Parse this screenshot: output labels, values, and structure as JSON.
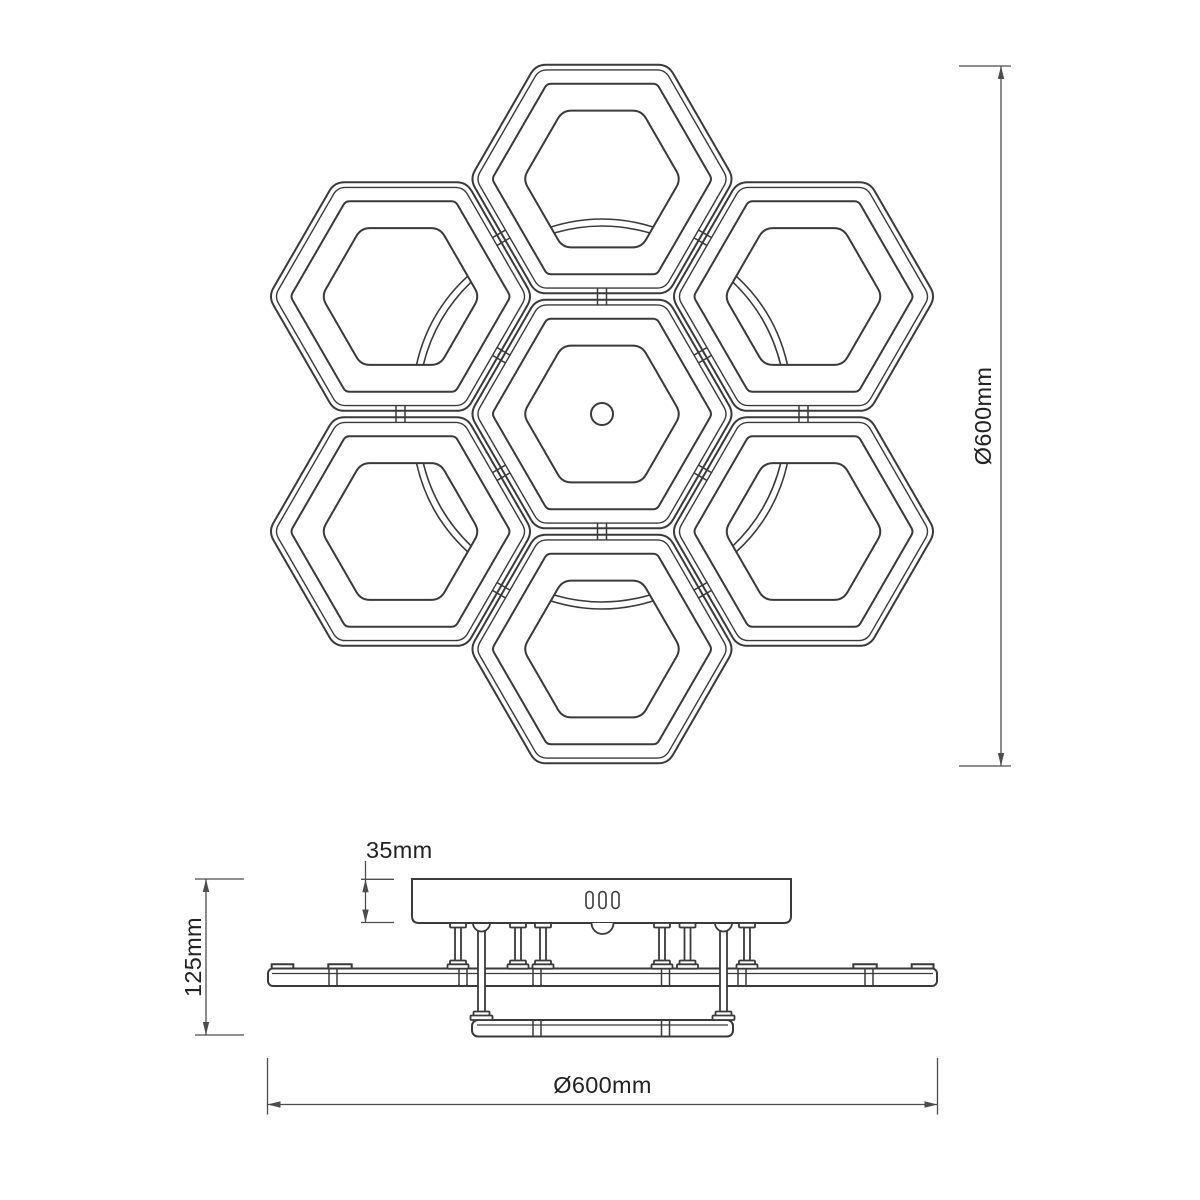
{
  "labels": {
    "dia_right": "Ø600mm",
    "dia_bottom": "Ø600mm",
    "height_total": "125mm",
    "canopy_height": "35mm"
  },
  "values": {
    "diameter_mm": 600,
    "total_height_mm": 125,
    "canopy_height_mm": 35
  },
  "colors": {
    "background": "#ffffff",
    "object_line": "#3a3a3a",
    "thin_line": "#4a4a4a",
    "dim_line": "#4d4d4d",
    "text": "#222222",
    "fill_white": "#ffffff"
  },
  "top_view": {
    "hex_side_outer": 132,
    "hex_side_offset": 126,
    "hex_side_mid": 110,
    "hex_side_inner": 79,
    "corner_radius": {
      "outer": 10,
      "offset": 8,
      "mid": 4,
      "inner": 9
    },
    "center_hole_radius": 11,
    "modules": [
      {
        "id": "center",
        "cx": 602,
        "cy": 414,
        "feature": "center-hole"
      },
      {
        "id": "top",
        "cx": 602,
        "cy": 179,
        "feature": "lens",
        "angle": 0
      },
      {
        "id": "upper-right",
        "cx": 803.5,
        "cy": 296.5,
        "feature": "lens",
        "angle": 60
      },
      {
        "id": "lower-right",
        "cx": 803.5,
        "cy": 531.5,
        "feature": "lens",
        "angle": 120
      },
      {
        "id": "bottom",
        "cx": 602,
        "cy": 649,
        "feature": "lens",
        "angle": 180
      },
      {
        "id": "lower-left",
        "cx": 400.5,
        "cy": 531.5,
        "feature": "lens",
        "angle": 240
      },
      {
        "id": "upper-left",
        "cx": 400.5,
        "cy": 296.5,
        "feature": "lens",
        "angle": 300
      }
    ],
    "connector_pairs": [
      [
        0,
        1
      ],
      [
        0,
        2
      ],
      [
        0,
        3
      ],
      [
        0,
        4
      ],
      [
        0,
        5
      ],
      [
        0,
        6
      ],
      [
        1,
        2
      ],
      [
        2,
        3
      ],
      [
        3,
        4
      ],
      [
        4,
        5
      ],
      [
        5,
        6
      ],
      [
        6,
        1
      ]
    ],
    "connector": {
      "half_len": 8,
      "half_gap": 4.5
    },
    "lens": {
      "arc1": {
        "x1": -51,
        "y1": 48,
        "cx": 0,
        "cy": 32,
        "x2": 51,
        "y2": 48
      },
      "arc2": {
        "x1": -48,
        "y1": 54,
        "cx": 0,
        "cy": 40,
        "x2": 48,
        "y2": 54
      }
    }
  },
  "side_view": {
    "canopy": {
      "x1": 412,
      "x2": 791,
      "y1": 879,
      "y2": 923,
      "corner": 7
    },
    "slots": {
      "xs": [
        589.5,
        602.5,
        615.5
      ],
      "y": 891.5,
      "w": 7,
      "h": 17
    },
    "center_dome": {
      "cx": 602.5,
      "y": 923,
      "r": 11
    },
    "long_posts": {
      "xs": [
        481.5,
        723.5
      ],
      "dome_r": 8.5,
      "shaft_w": 7,
      "shaft_y1": 927,
      "shaft_y2": 1013,
      "foot": {
        "w": 16,
        "y": 1011.5,
        "h": 4.5
      },
      "pad": {
        "w": 22,
        "y": 1015.5,
        "h": 4.5
      }
    },
    "short_posts": {
      "xs": [
        458,
        518,
        543,
        662,
        687.5,
        747
      ],
      "cap": {
        "w": 16,
        "y": 923,
        "h": 4.5
      },
      "shaft": {
        "w": 6,
        "y1": 923,
        "y2": 962
      },
      "foot": {
        "w": 16,
        "y": 960.5,
        "h": 4.5
      },
      "pad": {
        "w": 21,
        "y": 964.3,
        "h": 4.4
      }
    },
    "main_plate": {
      "x1": 268,
      "x2": 937,
      "y1": 968.5,
      "y2": 986,
      "corner": 5,
      "inner_line_y": 973.5,
      "tabs": [
        [
          271.7,
          293.3
        ],
        [
          328.3,
          351.7
        ],
        [
          853.3,
          876.7
        ],
        [
          911.7,
          933.5
        ]
      ],
      "tab_h": 4.2,
      "seams": [
        333,
        463,
        537,
        665.5,
        742,
        869
      ]
    },
    "lower_plate": {
      "x1": 472,
      "x2": 733,
      "y1": 1020,
      "y2": 1036.5,
      "corner": 6,
      "inner_line_y": 1025,
      "seams": [
        537,
        665.5
      ]
    },
    "seam_half_gap": 4
  },
  "dimensions": {
    "right_diameter": {
      "x": 1001,
      "y1": 66,
      "y2": 766,
      "tick_x1": 959,
      "tick_x2": 1011
    },
    "bottom_diameter": {
      "y": 1104.5,
      "x1": 267.5,
      "x2": 937.5,
      "ext_y1": 1058,
      "ext_y2": 1114.5
    },
    "total_height": {
      "x": 206,
      "y1": 879,
      "y2": 1035,
      "tick_x1": 195,
      "tick_x2": 244
    },
    "canopy_height": {
      "x": 365.5,
      "y1": 879.3,
      "y2": 922.5,
      "leader_top": 861,
      "tick_x1": 361,
      "tick_x2": 394
    },
    "arrow": {
      "len": 13,
      "half_w": 3.2
    }
  }
}
